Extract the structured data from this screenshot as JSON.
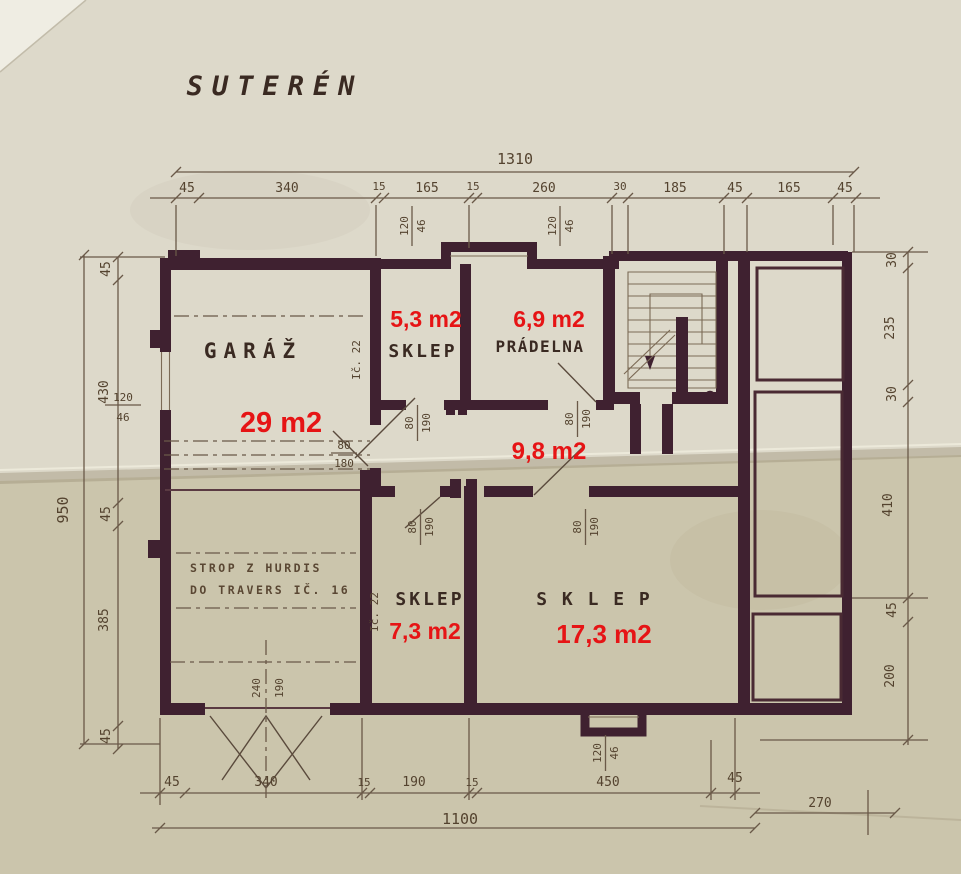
{
  "drawing": {
    "title": "SUTERÉN",
    "rooms": [
      {
        "label": "GARÁŽ",
        "area": "29 m2"
      },
      {
        "label": "SKLEP",
        "area": "5,3 m2"
      },
      {
        "label": "PRÁDELNA",
        "area": "6,9 m2"
      },
      {
        "label": "",
        "area": "9,8 m2"
      },
      {
        "label": "SKLEP",
        "area": "7,3 m2"
      },
      {
        "label": "S K L E P",
        "area": "17,3 m2"
      }
    ],
    "notes": {
      "ceiling_1": "STROP Z HURDIS",
      "ceiling_2": "DO TRAVERS IČ. 16",
      "beam_upper": "Ič. 22",
      "beam_lower": "Ič. 22"
    },
    "dims": {
      "top_total": "1310",
      "top_segments": [
        "45",
        "340",
        "15",
        "165",
        "15",
        "260",
        "30",
        "185",
        "45",
        "165",
        "45"
      ],
      "left_total": "950",
      "left_segments": [
        "45",
        "430",
        "45",
        "385",
        "45"
      ],
      "right_segments": [
        "30",
        "235",
        "30",
        "410",
        "45",
        "200"
      ],
      "bottom_segments": [
        "45",
        "340",
        "15",
        "190",
        "15",
        "450",
        "45"
      ],
      "bottom_total": "1100",
      "bottom_extension": "270",
      "door_w": "80",
      "door_h": "190",
      "garage_door_h": "180",
      "window_w": "120",
      "window_h": "46",
      "gate_w": "240",
      "gate_h": "190"
    },
    "colors": {
      "red": "#e61415",
      "wall": "#3f2130",
      "line": "#6a5948",
      "paper_top": "#ddd9ca",
      "paper_bottom": "#cbc5ac"
    }
  }
}
